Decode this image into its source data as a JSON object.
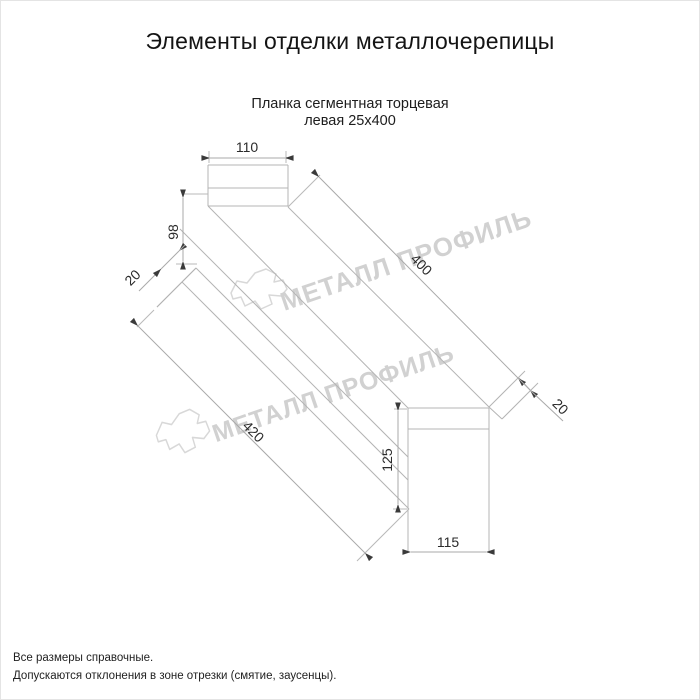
{
  "page": {
    "title": "Элементы отделки металлочерепицы",
    "subtitle_line1": "Планка сегментная торцевая",
    "subtitle_line2": "левая 25х400"
  },
  "watermark": {
    "text": "МЕТАЛЛ ПРОФИЛЬ",
    "color": "#cacaca"
  },
  "dimensions": {
    "top_width": "110",
    "left_height": "98",
    "left_flange": "20",
    "top_length": "400",
    "bottom_length": "420",
    "right_flange": "20",
    "right_height": "125",
    "bottom_width": "115"
  },
  "footer": {
    "line1": "Все размеры справочные.",
    "line2": "Допускаются отклонения в зоне отрезки (смятие, заусенцы)."
  },
  "colors": {
    "line": "#b4b4b4",
    "arrow": "#3a3a3a",
    "text": "#2b2b2b"
  }
}
